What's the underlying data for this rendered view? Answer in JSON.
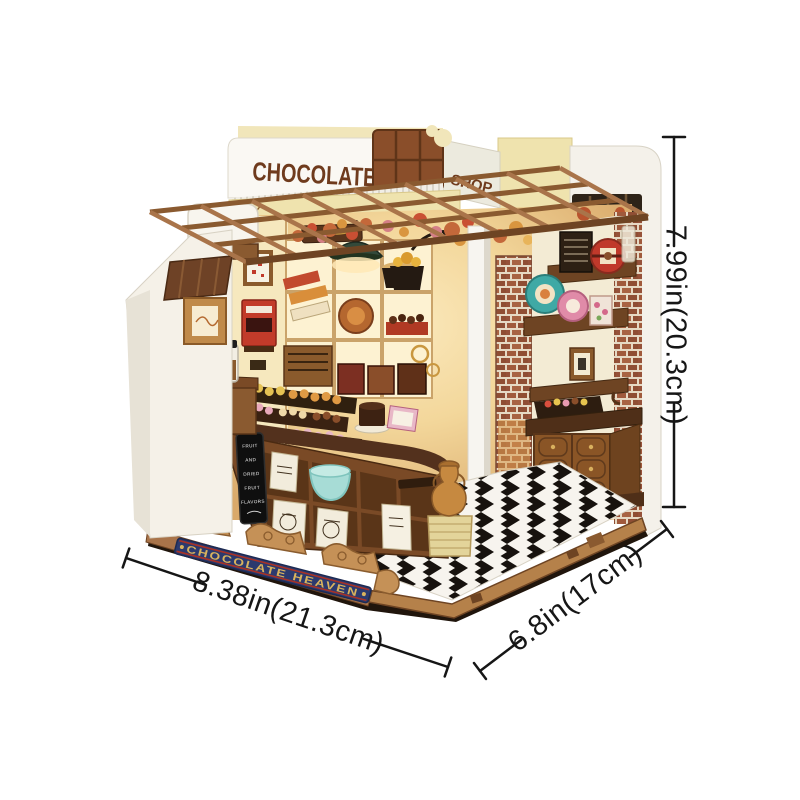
{
  "scene": {
    "title_sign": "CHOCOLATE",
    "side_sign": "SHOP",
    "base_banner": "CHOCOLATE HEAVEN",
    "menu_board_lines": [
      "FRUIT",
      "AND",
      "DRIED",
      "FRUIT",
      "FLAVORS"
    ]
  },
  "dimensions": {
    "height": "7.99in(20.3cm)",
    "width": "8.38in(21.3cm)",
    "depth": "6.8in(17cm)"
  },
  "colors": {
    "background": "#ffffff",
    "sign_text": "#6f3b1d",
    "chocolate_bar": "#8a4e2a",
    "banner_bg": "#2c3a6e",
    "banner_text": "#d9b35e",
    "dimension_line": "#161616",
    "pergola_wood": "#a9744a",
    "wall_cream": "#f3e9c8",
    "lamp_green": "#33493a",
    "tin_teal": "#3fa9a5",
    "tin_pink": "#e08ba8",
    "tin_red": "#c0392b",
    "floor_dark": "#17120e",
    "floor_light": "#f7f4ee"
  }
}
